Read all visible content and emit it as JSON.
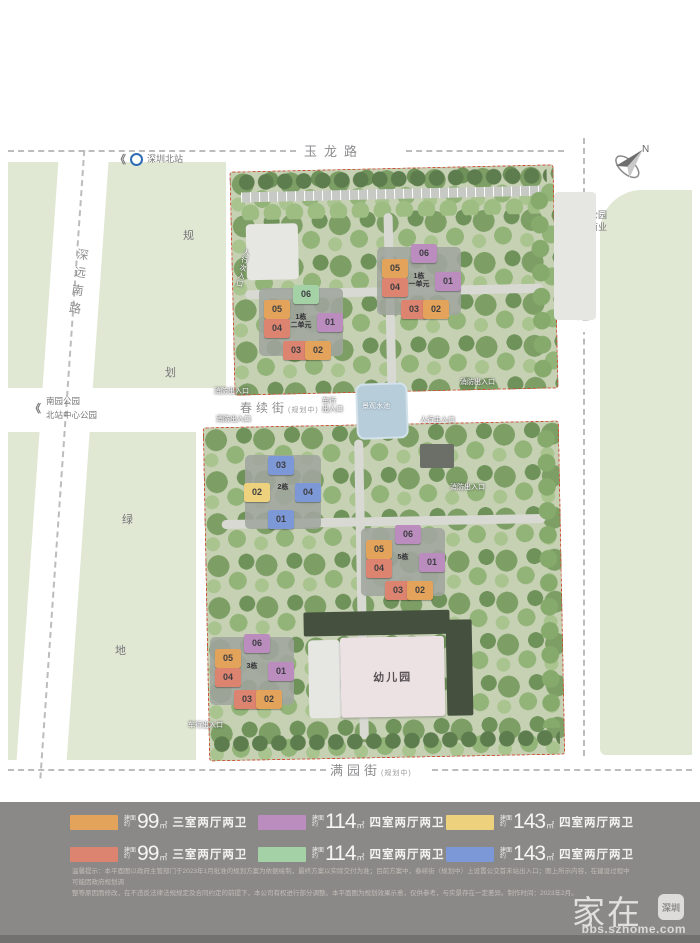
{
  "title": {
    "brand1": "超核中心",
    "brand2": "润府",
    "suffix": "项目总平图"
  },
  "roads": {
    "top": "玉龙路",
    "left": "深远南路",
    "right": "龙华大道",
    "middle": "春续街",
    "middle_note": "(规划中)",
    "bottom": "满园街",
    "bottom_note": "(规划中)"
  },
  "landmarks": {
    "metro": "深圳北站",
    "park_left1": "南园公园",
    "park_left2": "北站中心公园",
    "park_right1": "绿芯公园",
    "park_right2": "万象商业",
    "plan1": "规",
    "plan2": "划",
    "green1": "绿",
    "green2": "地",
    "water": "景观水池",
    "kindergarten": "幼儿园",
    "compass_n": "N"
  },
  "colors": {
    "orange": "#e3a35b",
    "salmon": "#dd8471",
    "purple": "#ba8dbe",
    "green": "#a4d2a6",
    "yellow": "#edd17d",
    "blue": "#7d98d6"
  },
  "clusters": [
    {
      "label": "1栋\n二单元",
      "x": 301,
      "y": 322,
      "w": 84,
      "h": 68,
      "units": [
        {
          "n": "06",
          "c": "green",
          "dx": 5,
          "dy": -28
        },
        {
          "n": "05",
          "c": "orange",
          "dx": -24,
          "dy": -13
        },
        {
          "n": "04",
          "c": "salmon",
          "dx": -24,
          "dy": 6
        },
        {
          "n": "01",
          "c": "purple",
          "dx": 29,
          "dy": 0
        },
        {
          "n": "03",
          "c": "salmon",
          "dx": -5,
          "dy": 28
        },
        {
          "n": "02",
          "c": "orange",
          "dx": 17,
          "dy": 28
        }
      ]
    },
    {
      "label": "1栋\n一单元",
      "x": 419,
      "y": 281,
      "w": 84,
      "h": 68,
      "units": [
        {
          "n": "06",
          "c": "purple",
          "dx": 5,
          "dy": -28
        },
        {
          "n": "05",
          "c": "orange",
          "dx": -24,
          "dy": -13
        },
        {
          "n": "04",
          "c": "salmon",
          "dx": -24,
          "dy": 6
        },
        {
          "n": "01",
          "c": "purple",
          "dx": 29,
          "dy": 0
        },
        {
          "n": "03",
          "c": "salmon",
          "dx": -5,
          "dy": 28
        },
        {
          "n": "02",
          "c": "orange",
          "dx": 17,
          "dy": 28
        }
      ]
    },
    {
      "label": "2栋",
      "x": 283,
      "y": 492,
      "w": 76,
      "h": 74,
      "units": [
        {
          "n": "03",
          "c": "blue",
          "dx": -2,
          "dy": -27
        },
        {
          "n": "02",
          "c": "yellow",
          "dx": -26,
          "dy": 0
        },
        {
          "n": "04",
          "c": "blue",
          "dx": 25,
          "dy": 0
        },
        {
          "n": "01",
          "c": "blue",
          "dx": -2,
          "dy": 27
        }
      ]
    },
    {
      "label": "5栋",
      "x": 403,
      "y": 562,
      "w": 84,
      "h": 68,
      "units": [
        {
          "n": "06",
          "c": "purple",
          "dx": 5,
          "dy": -28
        },
        {
          "n": "05",
          "c": "orange",
          "dx": -24,
          "dy": -13
        },
        {
          "n": "04",
          "c": "salmon",
          "dx": -24,
          "dy": 6
        },
        {
          "n": "01",
          "c": "purple",
          "dx": 29,
          "dy": 0
        },
        {
          "n": "03",
          "c": "salmon",
          "dx": -5,
          "dy": 28
        },
        {
          "n": "02",
          "c": "orange",
          "dx": 17,
          "dy": 28
        }
      ]
    },
    {
      "label": "3栋",
      "x": 252,
      "y": 671,
      "w": 84,
      "h": 68,
      "units": [
        {
          "n": "06",
          "c": "purple",
          "dx": 5,
          "dy": -28
        },
        {
          "n": "05",
          "c": "orange",
          "dx": -24,
          "dy": -13
        },
        {
          "n": "04",
          "c": "salmon",
          "dx": -24,
          "dy": 6
        },
        {
          "n": "01",
          "c": "purple",
          "dx": 29,
          "dy": 0
        },
        {
          "n": "03",
          "c": "salmon",
          "dx": -5,
          "dy": 28
        },
        {
          "n": "02",
          "c": "orange",
          "dx": 17,
          "dy": 28
        }
      ]
    }
  ],
  "entrances": [
    {
      "t": "人行次入口",
      "x": 238,
      "y": 248,
      "vert": true,
      "rot": 12
    },
    {
      "t": "消防出入口",
      "x": 214,
      "y": 388
    },
    {
      "t": "消防出入口",
      "x": 216,
      "y": 416
    },
    {
      "t": "车行\n出入口",
      "x": 322,
      "y": 398
    },
    {
      "t": "人行主入口",
      "x": 420,
      "y": 417
    },
    {
      "t": "消防出入口",
      "x": 460,
      "y": 379
    },
    {
      "t": "消防出入口",
      "x": 450,
      "y": 484
    },
    {
      "t": "车行出入口",
      "x": 188,
      "y": 722
    }
  ],
  "legend": {
    "prefix1": "建面",
    "prefix2": "约",
    "unit": "㎡",
    "items": [
      {
        "c": "orange",
        "area": "99",
        "desc": "三室两厅两卫"
      },
      {
        "c": "purple",
        "area": "114",
        "desc": "四室两厅两卫"
      },
      {
        "c": "yellow",
        "area": "143",
        "desc": "四室两厅两卫"
      },
      {
        "c": "salmon",
        "area": "99",
        "desc": "三室两厅两卫"
      },
      {
        "c": "green",
        "area": "114",
        "desc": "四室两厅两卫"
      },
      {
        "c": "blue",
        "area": "143",
        "desc": "四室两厅两卫"
      }
    ]
  },
  "disclaimer": {
    "line1": "温馨提示：本平面图以政府主管部门于2023年1月批准的规划方案为依据绘制，最终方案以实际交付为准；目前方案中，春续街（规划中）上设置公交首末站出入口；图上所示内容，在建设过程中可能因政府规划调",
    "line2": "整等原因而修改，在不违反法律法规规定及合同约定的前提下，本公司有权进行部分调整。本平面图为规划效果示意，仅供参考，与实景存在一定差异。制作时间：2023年2月。"
  },
  "watermark": {
    "brand": "家在",
    "badge": "深圳",
    "url": "bbs.szhome.com"
  }
}
